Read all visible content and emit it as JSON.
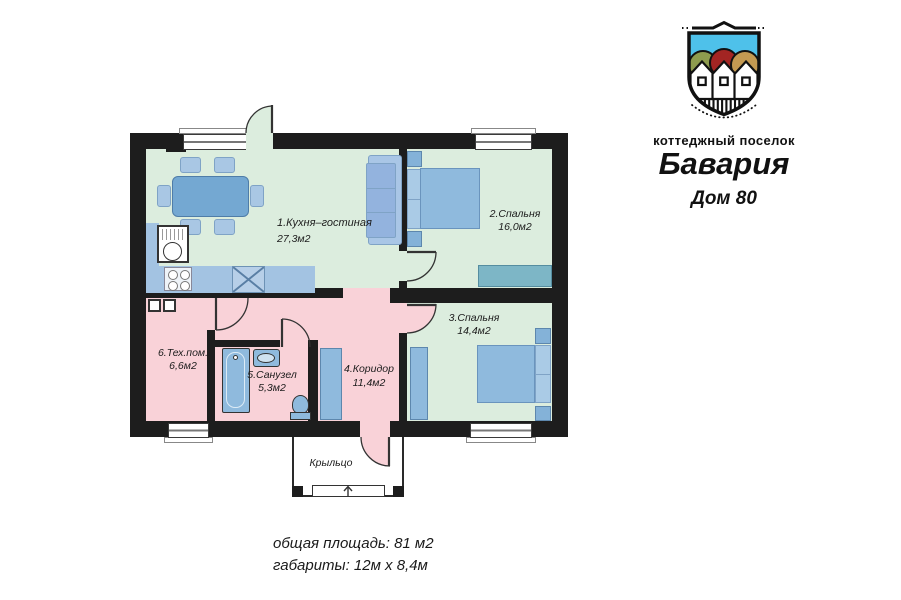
{
  "header": {
    "village_label": "коттеджный поселок",
    "village_name": "Бавария",
    "house_number": "Дом 80"
  },
  "plan": {
    "rooms": [
      {
        "label": "1.Кухня–гостиная",
        "area": "27,3м2"
      },
      {
        "label": "2.Спальня",
        "area": "16,0м2"
      },
      {
        "label": "3.Спальня",
        "area": "14,4м2"
      },
      {
        "label": "4.Коридор",
        "area": "11,4м2"
      },
      {
        "label": "5.Санузел",
        "area": "5,3м2"
      },
      {
        "label": "6.Тех.пом.",
        "area": "6,6м2"
      }
    ],
    "porch_label": "Крыльцо"
  },
  "summary": {
    "total_area": "общая площадь: 81 м2",
    "dimensions": "габариты: 12м х 8,4м"
  },
  "colors": {
    "wall": "#1d1d1d",
    "room_green": "#dcedde",
    "room_pink": "#f9d2d8",
    "furniture_blue": "#8fbadd",
    "furniture_light": "#a9c7e4",
    "counter_blue": "#a3c3e2",
    "dresser_teal": "#7db6c6",
    "logo_sky": "#4ec1ea",
    "logo_olive": "#8e9c4e",
    "logo_red": "#a32523",
    "logo_tan": "#c49a52"
  }
}
